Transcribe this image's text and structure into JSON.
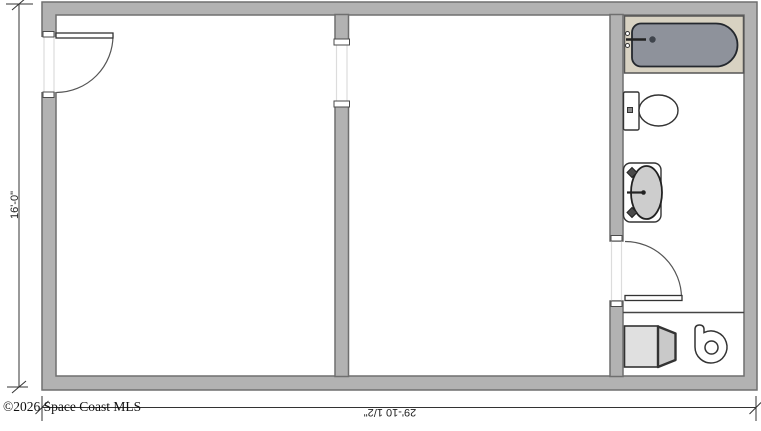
{
  "plan": {
    "copyright": "©2026 Space Coast MLS",
    "dimensions": {
      "height": "16'-0\"",
      "width": "29'-10 1/2\""
    },
    "fixtures": [
      "bathtub",
      "toilet",
      "sink-vanity",
      "entry-door",
      "bathroom-door",
      "cased-opening",
      "washer",
      "water-heater"
    ],
    "colors": {
      "wall": "#b2b2b2",
      "wall_outline": "#6f6f6f",
      "surround": "#d8d2c2",
      "tub": "#8e929b",
      "basin": "#cdcdcd",
      "appliance": "#e0e0e0"
    }
  }
}
